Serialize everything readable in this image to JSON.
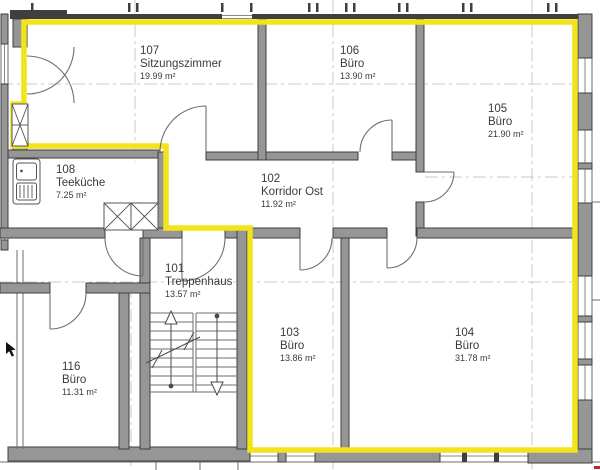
{
  "colors": {
    "highlight": "#f2e41c",
    "wall_fill": "#969696",
    "wall_outline": "#3f3f3f",
    "line": "#6e6e6e",
    "glass": "#8a8a8a",
    "axis": "#c9c9c9",
    "label": "#3a3a3a",
    "fixture": "#555555",
    "cursor": "#111111",
    "red_mark": "#b03030"
  },
  "rooms": [
    {
      "number": "107",
      "name": "Sitzungszimmer",
      "area": "19.99 m²"
    },
    {
      "number": "106",
      "name": "Büro",
      "area": "13.90 m²"
    },
    {
      "number": "105",
      "name": "Büro",
      "area": "21.90 m²"
    },
    {
      "number": "108",
      "name": "Teeküche",
      "area": "7.25 m²"
    },
    {
      "number": "102",
      "name": "Korridor Ost",
      "area": "11.92 m²"
    },
    {
      "number": "101",
      "name": "Treppenhaus",
      "area": "13.57 m²"
    },
    {
      "number": "103",
      "name": "Büro",
      "area": "13.86 m²"
    },
    {
      "number": "104",
      "name": "Büro",
      "area": "31.78 m²"
    },
    {
      "number": "116",
      "name": "Büro",
      "area": "11.31 m²"
    }
  ],
  "icons": {
    "cursor": "cursor-icon",
    "sink": "sink-icon",
    "stairs": "stairs-icon",
    "shaft": "shaft-x-icon",
    "cabinets": "cabinet-x-icon"
  }
}
